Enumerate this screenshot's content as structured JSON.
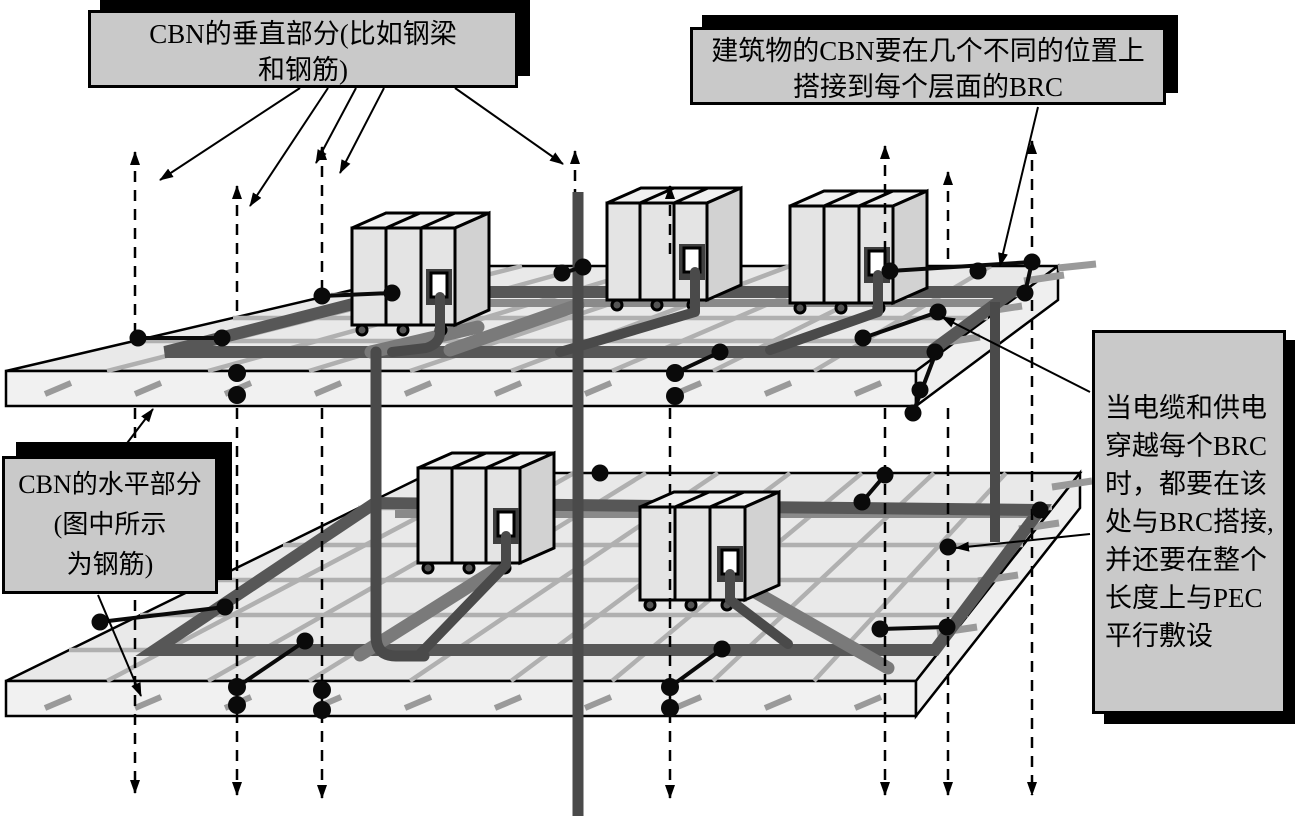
{
  "callouts": {
    "vertical_cbn": {
      "lines": [
        "CBN的垂直部分(比如钢梁",
        "和钢筋)"
      ]
    },
    "building_cbn": {
      "lines": [
        "建筑物的CBN要在几个不同的位置上",
        "搭接到每个层面的BRC"
      ]
    },
    "horizontal_cbn": {
      "lines": [
        "CBN的水平部分",
        "(图中所示",
        "为钢筋)"
      ]
    },
    "cable_bonding": {
      "lines": [
        "当电缆和供电",
        "穿越每个BRC",
        "时，都要在该",
        "处与BRC搭接,",
        "并还要在整个",
        "长度上与PEC",
        "平行敷设"
      ]
    }
  },
  "diagram": {
    "floors": [
      "upper-floor-slab",
      "lower-floor-slab"
    ],
    "cabinet_count_upper": 3,
    "cabinet_count_lower": 2,
    "colors": {
      "callout_fill": "#c9c9c9",
      "callout_shadow": "#000000",
      "slab_fill": "#e9e9e9",
      "slab_edge_fill": "#f1f1f1",
      "rebar_mesh": "#b0b0b0",
      "brc_ring": "#575757",
      "riser_cable": "#4a4a4a",
      "bond_dot": "#0a0a0a"
    }
  }
}
